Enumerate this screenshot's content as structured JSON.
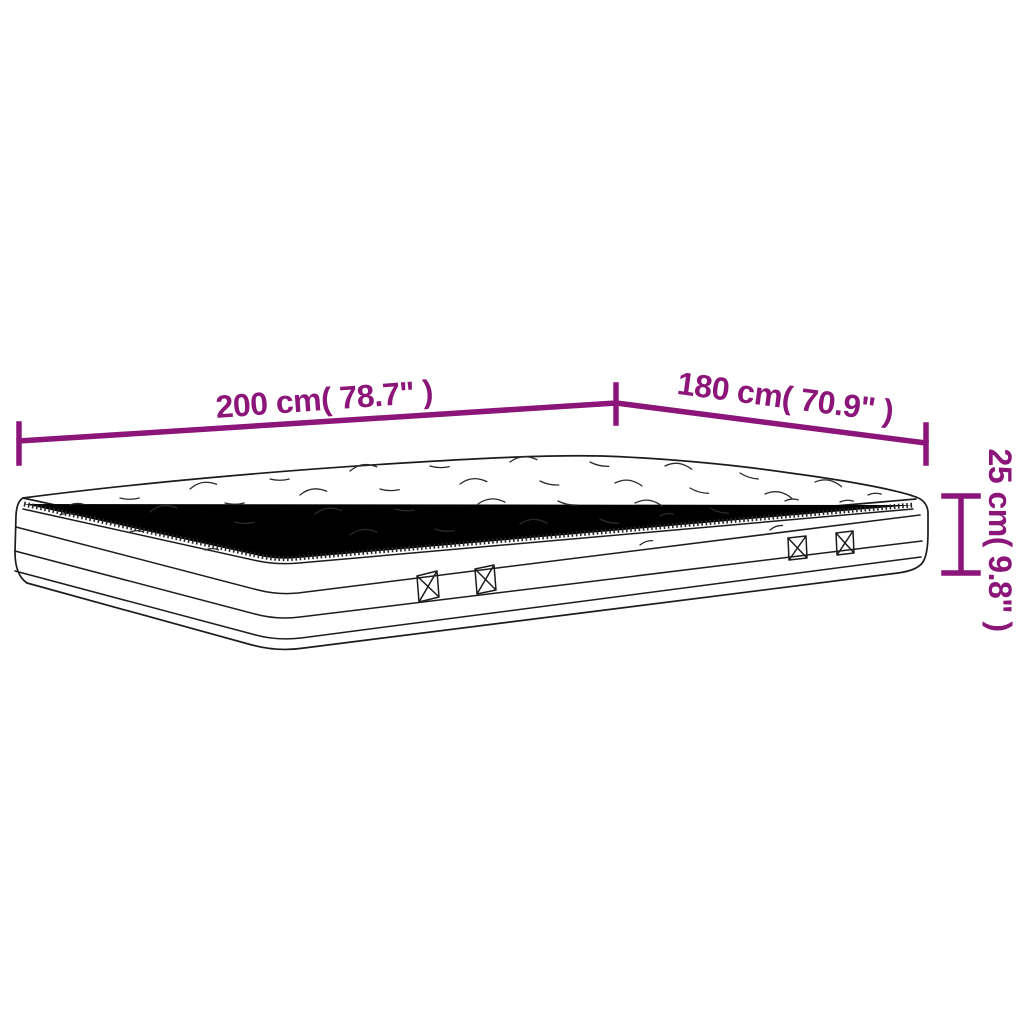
{
  "page": {
    "background_color": "#ffffff"
  },
  "diagram": {
    "name": "mattress-dimension-diagram",
    "subject": "line drawing of a quilted pillow-top mattress with four side handles",
    "accent_color": "#8B1578",
    "line_color": "#1c1c1c",
    "dimensions": {
      "length": {
        "label": "200 cm( 78.7\" )",
        "orientation": "diagonal-top-left"
      },
      "width": {
        "label": "180 cm( 70.9\" )",
        "orientation": "diagonal-top-right"
      },
      "height": {
        "label": "25 cm( 9.8\" )",
        "orientation": "vertical-right"
      }
    }
  }
}
